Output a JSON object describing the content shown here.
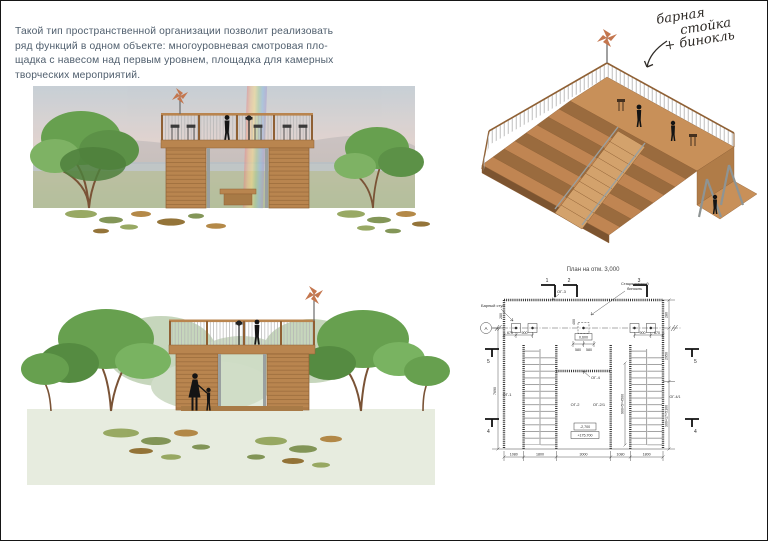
{
  "page": {
    "bg": "#ffffff",
    "border_color": "#161616"
  },
  "intro": {
    "color": "#4f5e6d",
    "lines": [
      "Такой тип пространственной организации позволит реализовать",
      "ряд функций в одном объекте: многоуровневая смотровая пло-",
      "щадка с навесом над первым уровнем, площадка для камерных",
      "творческих мероприятий."
    ]
  },
  "annotation": {
    "lines": [
      "барная",
      "стойка",
      "+ бинокль"
    ]
  },
  "colors": {
    "wood": "#b9854f",
    "wood_dark": "#8f6034",
    "wood_deck": "#c89059",
    "tree_green": "#67a04f",
    "tree_green_dark": "#4e7f3c",
    "tree_green_light": "#7eb264",
    "ground_green": "#e7ecdf",
    "rail_gray": "#bcbcbc",
    "steel_gray": "#9aa0a0",
    "silhouette": "#141414",
    "rooster_orange": "#c4764e",
    "ink": "#2b2b2b",
    "text_blue": "#4f5e6d"
  },
  "plan": {
    "title": "План на отм. 3,000",
    "labels": {
      "bar_stool": "Барный стул",
      "binocular_1": "Стационарный",
      "binocular_2": "бинокль",
      "og1": "ОГ-1",
      "og2": "ОГ-2",
      "og21": "ОГ-2/1",
      "og3": "ОГ-3",
      "og4": "ОГ-4",
      "og41": "ОГ-4/1",
      "axis_a": "А"
    },
    "sections": {
      "s1": "1",
      "s2": "2",
      "s3": "3",
      "s4": "4",
      "s5": "5"
    },
    "dims": {
      "d670": "670",
      "d900": "900",
      "d580": "580",
      "d400": "400",
      "d280": "280",
      "d2950": "2950",
      "d7690": "7690",
      "d300x17": "300×17=5100",
      "d900x5": "900×5=4500",
      "d1080": "1080",
      "d1800": "1800",
      "d3000": "3000",
      "d0600": "0,600",
      "elev_top": "-2,700",
      "elev_bottom": "+175,700"
    }
  }
}
